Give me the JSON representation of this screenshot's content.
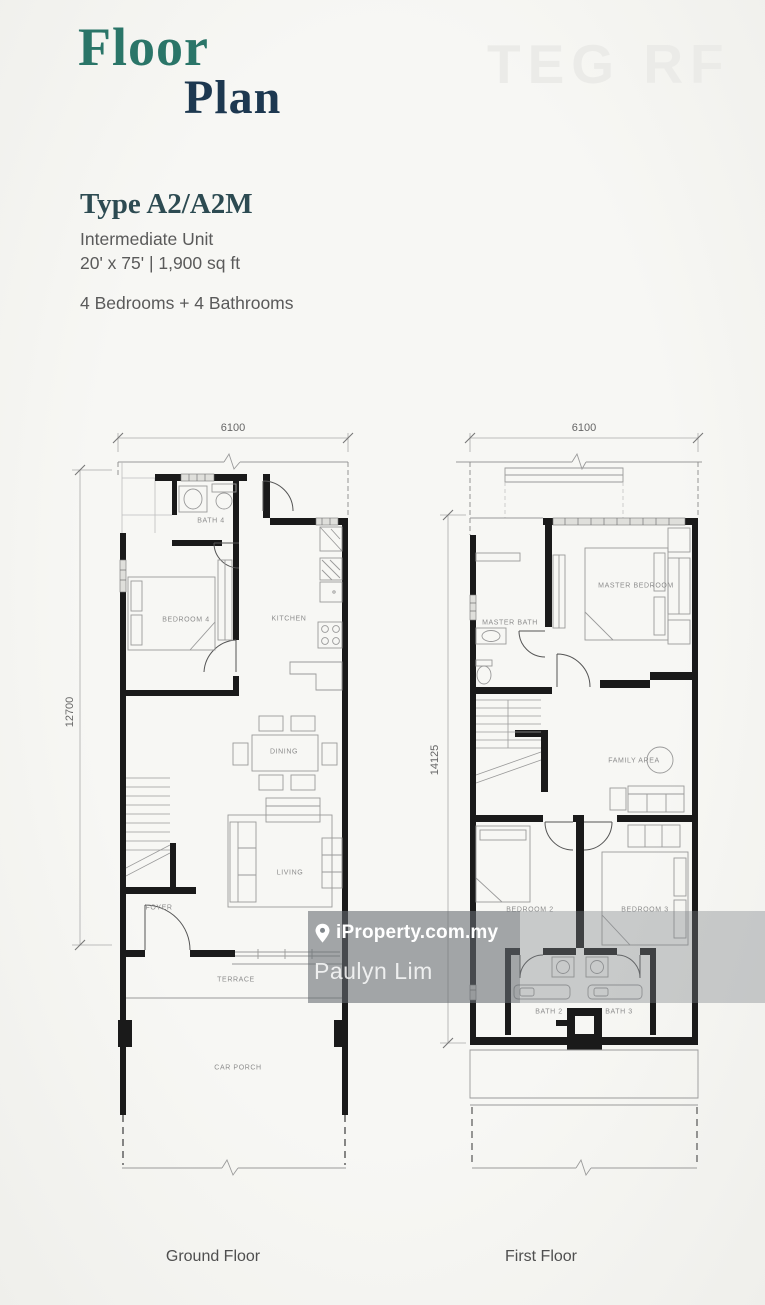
{
  "header": {
    "title_line1": "Floor",
    "title_line2": "Plan",
    "corner_watermark": "TEG RF"
  },
  "unit": {
    "type": "Type A2/A2M",
    "category": "Intermediate Unit",
    "size": "20' x 75' | 1,900 sq ft",
    "summary": "4 Bedrooms + 4 Bathrooms"
  },
  "plans": {
    "ground": {
      "caption": "Ground Floor",
      "width_dim": "6100",
      "height_dim": "12700",
      "rooms": {
        "bath4": "BATH 4",
        "bedroom4": "BEDROOM 4",
        "kitchen": "KITCHEN",
        "dining": "DINING",
        "living": "LIVING",
        "foyer": "FOYER",
        "terrace": "TERRACE",
        "car_porch": "CAR PORCH"
      }
    },
    "first": {
      "caption": "First Floor",
      "width_dim": "6100",
      "height_dim": "14125",
      "rooms": {
        "master_bath": "MASTER BATH",
        "master_bedroom": "MASTER BEDROOM",
        "family_area": "FAMILY AREA",
        "bedroom2": "BEDROOM 2",
        "bedroom3": "BEDROOM 3",
        "bath2": "BATH 2",
        "bath3": "BATH 3"
      }
    }
  },
  "overlay": {
    "brand": "iProperty.com.my",
    "agent": "Paulyn Lim",
    "pin_icon": "location-pin"
  },
  "colors": {
    "page_bg": "#f5f5f2",
    "title_teal": "#2a7568",
    "title_navy": "#1d3850",
    "heading_slate": "#2d4b52",
    "body_text": "#5a5a5a",
    "wall_black": "#1a1a1a",
    "thin_line": "#9a9a9a",
    "room_label": "#8c8c8c",
    "corner_watermark_gray": "#ebebe8",
    "overlay_band": "rgba(124,130,134,0.38)",
    "overlay_box": "rgba(88,94,99,0.34)",
    "overlay_text": "#ffffff"
  }
}
